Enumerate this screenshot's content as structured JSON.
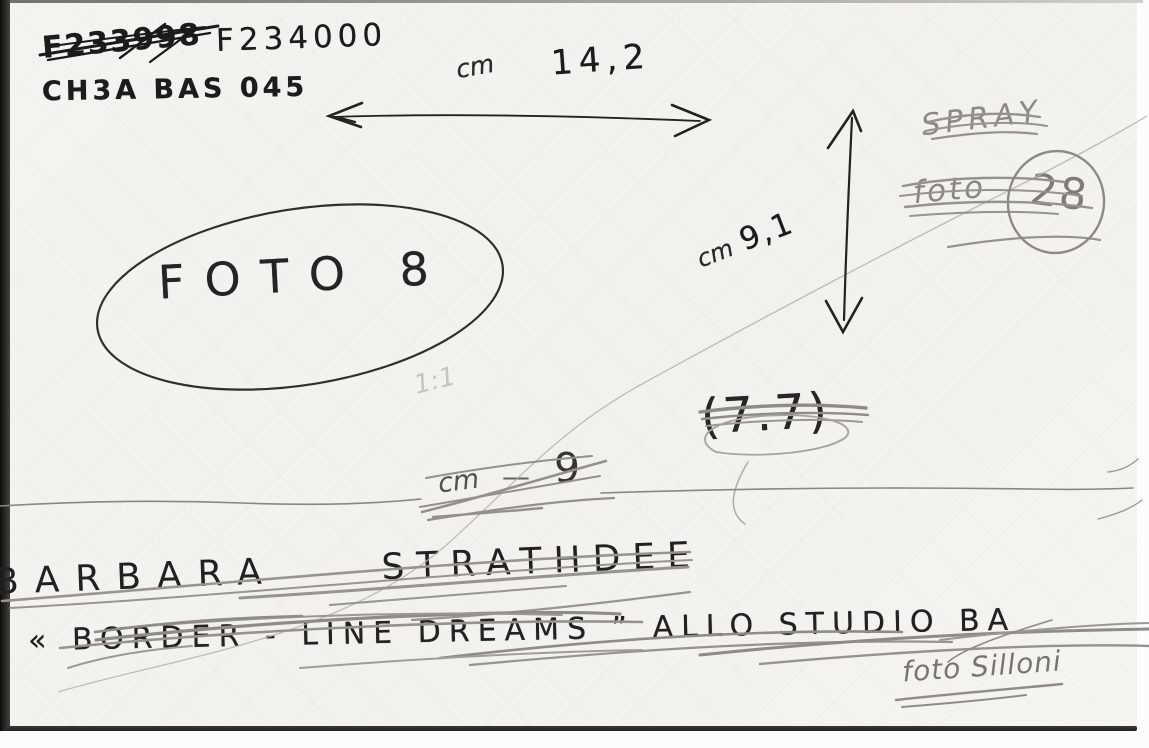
{
  "card": {
    "negative_numbers": {
      "old_crossed_out": "F233998",
      "current": "F234000"
    },
    "archive_code": "CH3A BAS 045",
    "photo_label": "FOTO 8",
    "measurements": {
      "width": {
        "unit": "cm",
        "value": "14,2"
      },
      "height": {
        "unit": "cm",
        "value": "9,1"
      },
      "crossed_out": {
        "unit": "cm",
        "dash": "—",
        "value": "9"
      },
      "ratio_crossed_out": "(7.7)",
      "scale_faint": "1:1"
    },
    "pencil_notes": {
      "spray_crossed_out": "SPRAY",
      "foto_crossed_out": "foto",
      "circled_number": "28"
    },
    "caption": {
      "artist_first_name": "BARBARA",
      "artist_last_name": "STRATHDEE",
      "title_crossed_out": "« BORDER - LINE DREAMS ” ALLO STUDIO BA",
      "photo_credit": "foto Silloni"
    }
  }
}
